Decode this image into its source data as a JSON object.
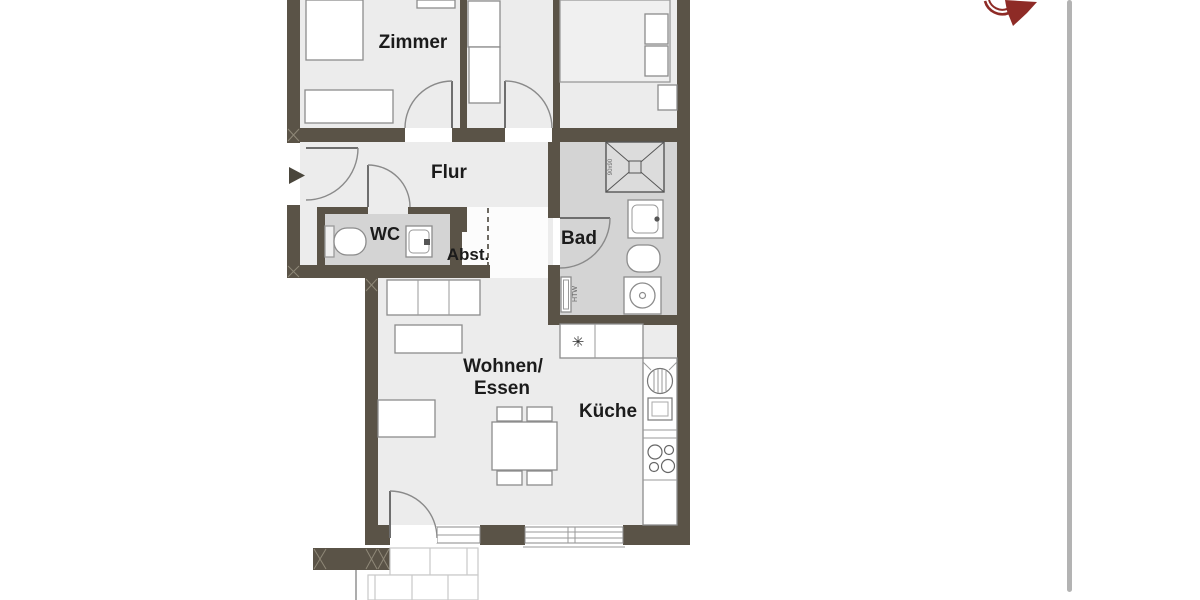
{
  "page": {
    "kind": "apartment floor plan drawing",
    "language": "de",
    "background": "#ffffff"
  },
  "floorplan": {
    "rooms": {
      "zimmer": "Zimmer",
      "flur": "Flur",
      "wc": "WC",
      "abstellraum": "Abst.",
      "bad": "Bad",
      "wohnen_essen_line1": "Wohnen/",
      "wohnen_essen_line2": "Essen",
      "kueche": "Küche"
    },
    "annotations": {
      "towel_radiator": "HTW",
      "shower_size": "90x90",
      "fridge_symbol": "✳"
    },
    "colors": {
      "wall": "#5A5347",
      "floor_dry": "#ECECEC",
      "floor_wet": "#D4D4D4",
      "furniture_outline": "#8C8C8C",
      "label_text": "#1B1B1B",
      "compass": "#8E2B26",
      "page_divider": "#B3B3B3"
    }
  }
}
